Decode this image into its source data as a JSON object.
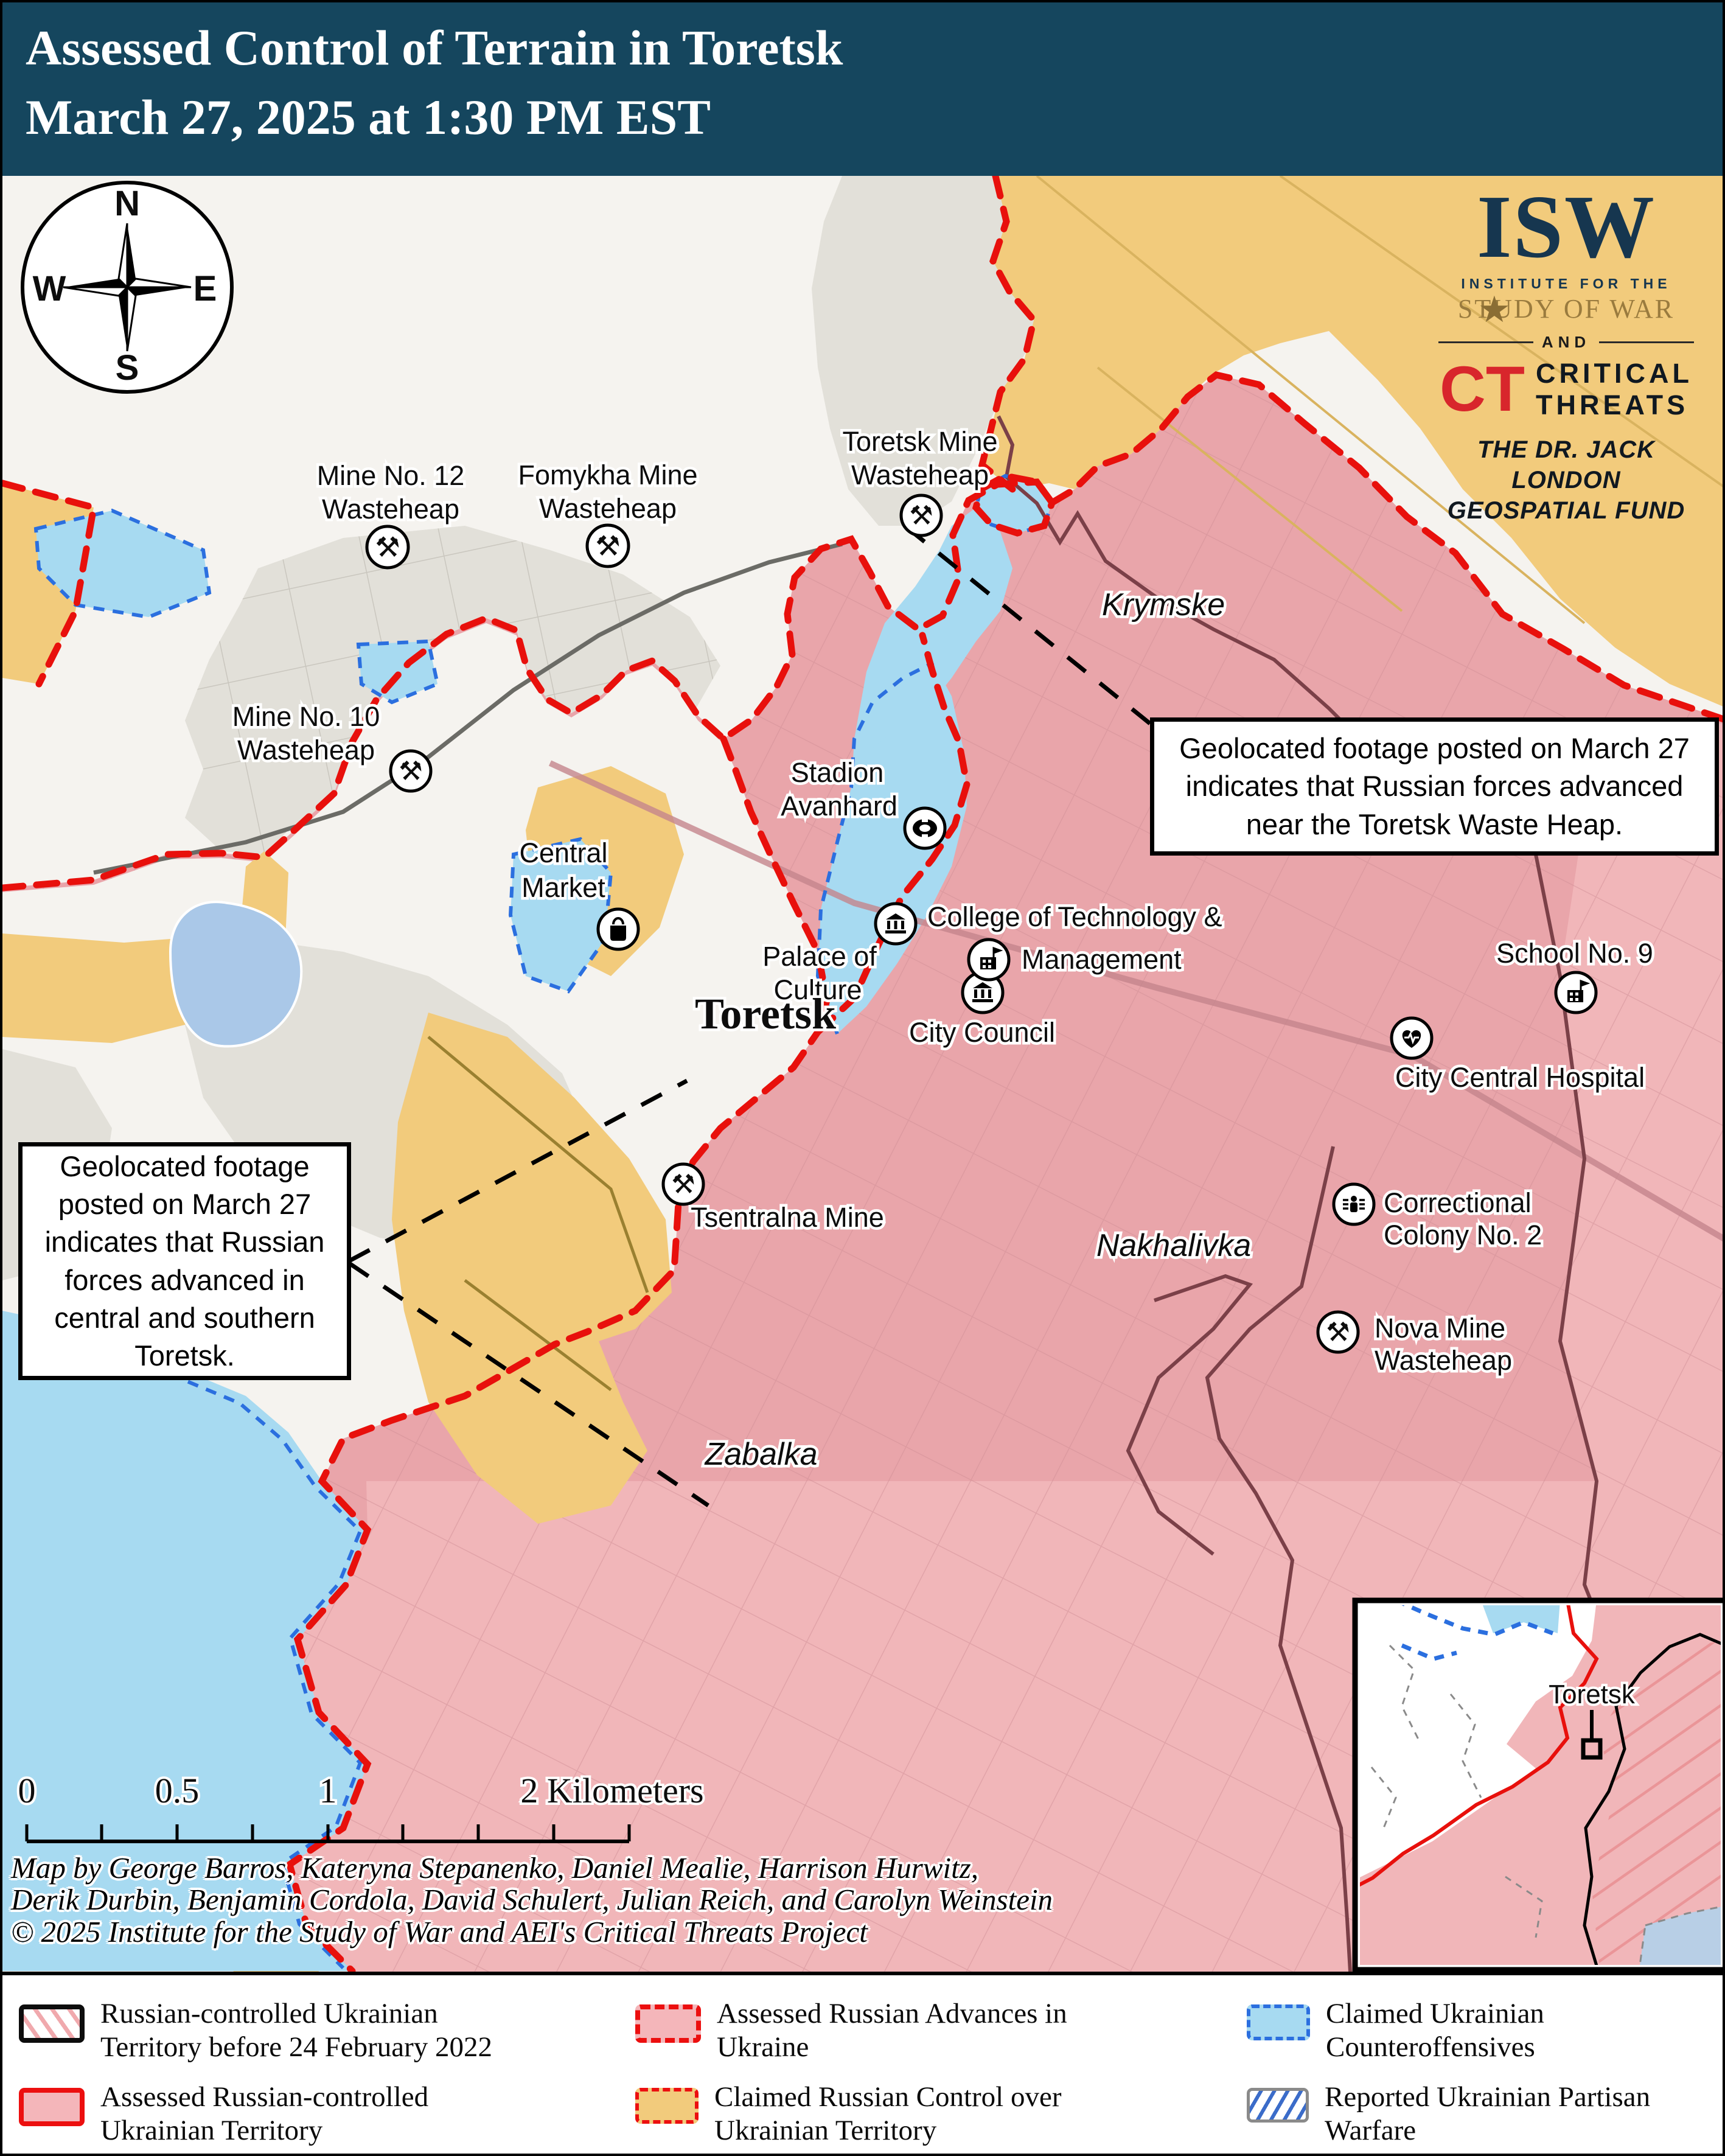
{
  "header": {
    "title_line1": "Assessed Control of Terrain in Toretsk",
    "title_line2": "March 27, 2025 at 1:30 PM EST"
  },
  "logo": {
    "isw": "ISW",
    "star": "★",
    "institute": "INSTITUTE FOR THE",
    "study_of_war": "STUDY OF WAR",
    "and": "AND",
    "ct": "CT",
    "critical": "CRITICAL",
    "threats": "THREATS",
    "fund_line1": "THE DR. JACK LONDON",
    "fund_line2": "GEOSPATIAL FUND"
  },
  "compass": {
    "n": "N",
    "e": "E",
    "s": "S",
    "w": "W"
  },
  "map": {
    "labels": {
      "mine12_l1": "Mine No. 12",
      "mine12_l2": "Wasteheap",
      "fomykha_l1": "Fomykha Mine",
      "fomykha_l2": "Wasteheap",
      "toretsk_mine_l1": "Toretsk Mine",
      "toretsk_mine_l2": "Wasteheap",
      "mine10_l1": "Mine No. 10",
      "mine10_l2": "Wasteheap",
      "stadion_l1": "Stadion",
      "stadion_l2": "Avanhard",
      "central_market_l1": "Central",
      "central_market_l2": "Market",
      "palace_l1": "Palace of",
      "palace_l2": "Culture",
      "college_l1": "College of Technology &",
      "college_l2": "Management",
      "city_council": "City Council",
      "school9": "School No. 9",
      "hospital": "City Central Hospital",
      "colony_l1": "Correctional",
      "colony_l2": "Colony No. 2",
      "nova_l1": "Nova Mine",
      "nova_l2": "Wasteheap",
      "tsentralna": "Tsentralna Mine",
      "toretsk_city": "Toretsk",
      "krymske": "Krymske",
      "nakhalivka": "Nakhalivka",
      "zabalka": "Zabalka"
    }
  },
  "callouts": {
    "left": {
      "lines": [
        "Geolocated footage",
        "posted on March 27",
        "indicates that Russian",
        "forces advanced in",
        "central and southern",
        "Toretsk."
      ]
    },
    "right": {
      "lines": [
        "Geolocated footage posted on March 27",
        "indicates that Russian forces advanced",
        "near the Toretsk Waste Heap."
      ]
    }
  },
  "scalebar": {
    "t0": "0",
    "t05": "0.5",
    "t1": "1",
    "t2": "2 Kilometers"
  },
  "credits": {
    "lines": [
      "Map by George Barros, Kateryna Stepanenko, Daniel Mealie, Harrison Hurwitz,",
      "Derik Durbin, Benjamin Cordola, David Schulert, Julian Reich, and Carolyn Weinstein",
      "© 2025 Institute for the Study of War and AEI's Critical Threats Project"
    ]
  },
  "legend": {
    "items": [
      {
        "l1": "Russian-controlled Ukrainian",
        "l2": "Territory before 24 February 2022"
      },
      {
        "l1": "Assessed Russian Advances in",
        "l2": "Ukraine"
      },
      {
        "l1": "Claimed Ukrainian",
        "l2": "Counteroffensives"
      },
      {
        "l1": "Assessed Russian-controlled",
        "l2": "Ukrainian Territory"
      },
      {
        "l1": "Claimed Russian Control over",
        "l2": "Ukrainian Territory"
      },
      {
        "l1": "Reported Ukrainian Partisan",
        "l2": "Warfare"
      }
    ]
  },
  "inset": {
    "label": "Toretsk"
  },
  "colors": {
    "header_navy": "#15465e",
    "neutral": "#f5f3ef",
    "gray_zone": "#e2e0d9",
    "russian_pink": "#e9a5aa",
    "russian_pink_light": "#f1b6b9",
    "claimed_orange": "#f2cb7c",
    "counter_blue": "#a7daf1",
    "water_blue": "#aac8e8",
    "advance_red": "#e8100c",
    "counter_blue_line": "#2b6fdf",
    "maroon_boundary": "#7b4048"
  }
}
